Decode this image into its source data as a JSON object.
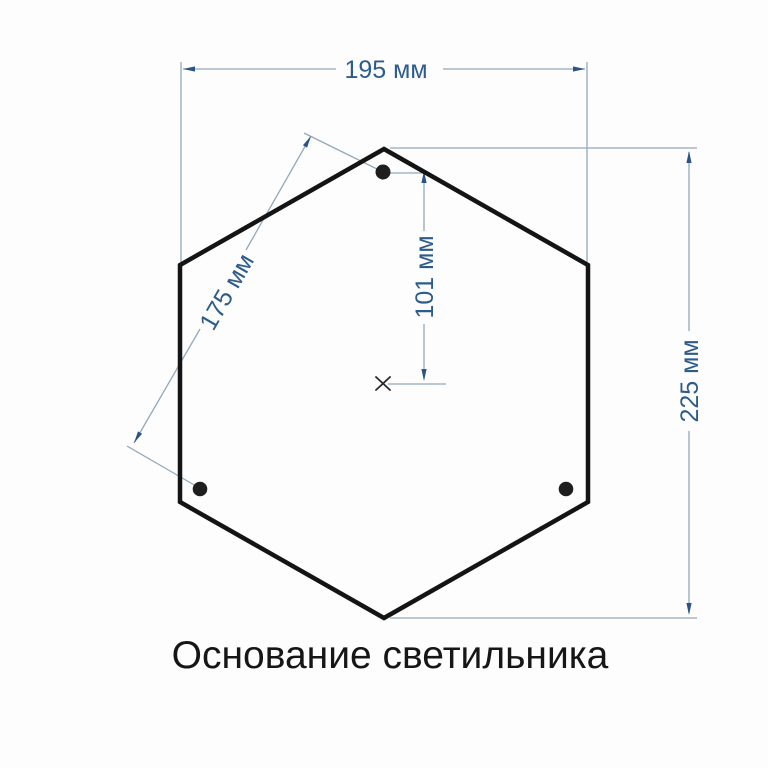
{
  "diagram": {
    "title": "Основание светильника",
    "type": "technical-dimension-drawing",
    "shape": "hexagon",
    "unit": "мм",
    "mounting_holes_count": 3,
    "dimensions": {
      "width": {
        "label": "195 мм",
        "value_mm": 195
      },
      "height": {
        "label": "225 мм",
        "value_mm": 225
      },
      "hole_spacing": {
        "label": "175 мм",
        "value_mm": 175
      },
      "hole_to_center": {
        "label": "101 мм",
        "value_mm": 101
      }
    },
    "colors": {
      "outline": "#141414",
      "dimension_line": "#93a9bb",
      "dimension_arrow": "#2a5486",
      "dimension_text": "#2d5c8c",
      "title_text": "#161616",
      "background": "#fdfdfd"
    }
  }
}
